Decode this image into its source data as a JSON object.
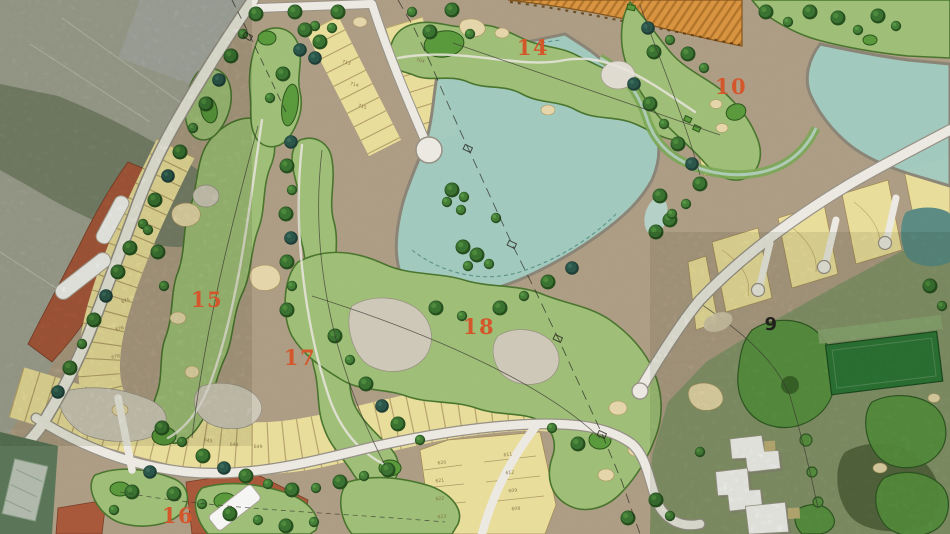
{
  "colors": {
    "ground": "#b5a48b",
    "farmland": "#a8a99b",
    "farmland_woods": "#79836b",
    "satellite_turf": "#8a9b6f",
    "satellite_woods": "#55683f",
    "lake": "#a9d4c9",
    "pond_dark": "#5f9188",
    "fairway": "#a6c67d",
    "fairway_outline": "#4d7a31",
    "green": "#5fa03e",
    "sand": "#eedfb2",
    "rock": "#d7d0c2",
    "lots": "#f3e6a2",
    "lot_line": "#a8905c",
    "lot_number": "#7d6b40",
    "road": "#f5f3ec",
    "road_casing": "#9d978c",
    "parcel_orange": "#e29a45",
    "parcel_orange_stripe": "#bb7a2c",
    "parcel_terracotta": "#b05c3d",
    "building_white": "#ffffff",
    "building_roof": "#b7c1b3",
    "facility_green": "#5e7a5c",
    "tree": "#3c7733",
    "tree_dark": "#2c5a4e",
    "range_green": "#2e7c38",
    "hole_label": "#d4572b",
    "hole_label_dark": "#20201c"
  },
  "hole_labels": [
    {
      "id": "hole-14",
      "label": "14"
    },
    {
      "id": "hole-10",
      "label": "10"
    },
    {
      "id": "hole-15",
      "label": "15"
    },
    {
      "id": "hole-17",
      "label": "17"
    },
    {
      "id": "hole-18",
      "label": "18"
    },
    {
      "id": "hole-16",
      "label": "16"
    },
    {
      "id": "hole-9",
      "label": "9"
    }
  ],
  "lot_numbers": {
    "strip_top_a": [
      "713",
      "714",
      "715"
    ],
    "strip_top_b": [
      "704"
    ],
    "strip_left": [
      "675",
      "676",
      "678"
    ],
    "strip_bottom": [
      "645",
      "648",
      "649"
    ],
    "block_center": [
      "620",
      "621",
      "622",
      "623",
      "611",
      "612",
      "609",
      "608"
    ]
  }
}
